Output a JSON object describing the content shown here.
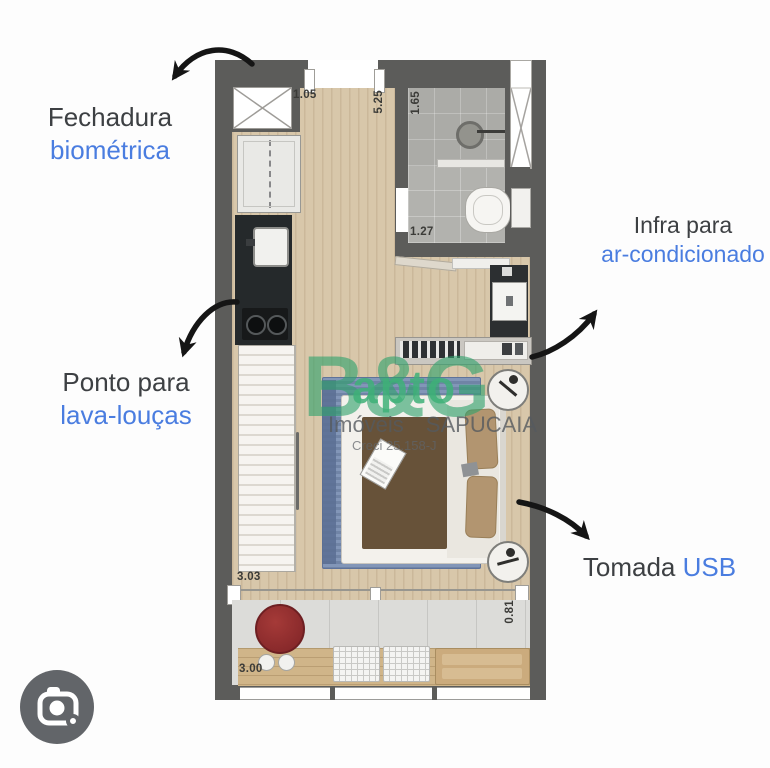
{
  "annotations": {
    "biometric_lock": {
      "black": "Fechadura",
      "blue": "biométrica"
    },
    "dishwasher_point": {
      "black": "Ponto para",
      "blue": "lava-louças"
    },
    "ac_infra": {
      "black": "Infra para",
      "blue": "ar-condicionado"
    },
    "usb_outlet": {
      "black": "Tomada",
      "blue": "USB"
    }
  },
  "dimensions": {
    "entry": "1.05",
    "room_depth": "5.25",
    "bath_width": "1.65",
    "bath_depth": "1.27",
    "wardrobe_wall": "3.03",
    "balcony_width": "3.00",
    "balcony_depth": "0.81"
  },
  "watermark": {
    "brand": "B&G",
    "brand_overlay": "apto",
    "word_left": "Imóveis",
    "word_right": "SAPUCAIA",
    "registry": "Creci 25.158-J"
  },
  "icons": {
    "bottom_left": "google-lens-camera-icon"
  },
  "colors": {
    "label_dark": "#3d4043",
    "label_blue": "#4a7de0",
    "watermark_green": "#2ea06e",
    "wall_gray": "#5c5c5a",
    "wood_floor": "#d8c7aa",
    "rug_blue": "#7e93b6",
    "table_red": "#8e2a2c",
    "lens_circle": "#626569"
  }
}
